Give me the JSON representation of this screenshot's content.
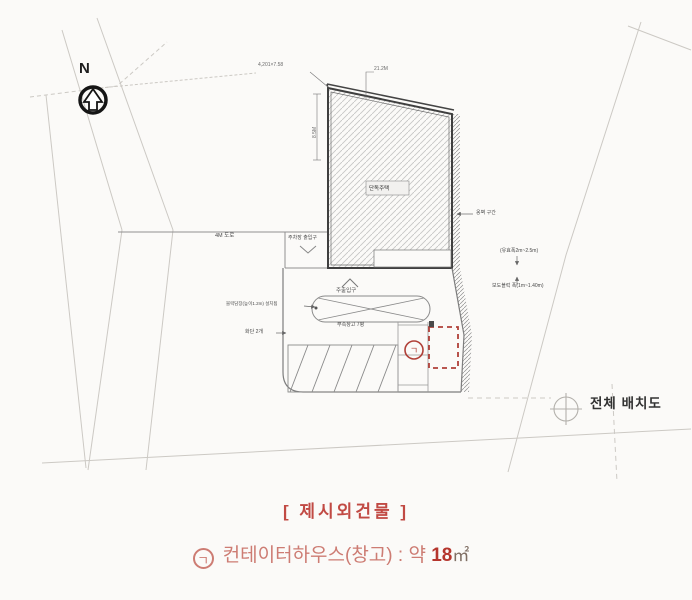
{
  "colors": {
    "red_annotation": "#b04038",
    "caption_heading": "#c14a44",
    "caption_text": "#cd7c73",
    "caption_value": "#b5352d"
  },
  "plan": {
    "north_label": "N",
    "title": "전체 배치도",
    "building": {
      "label": "단독주택"
    },
    "dimensions": {
      "top_left": "4,201×7.58",
      "top_right": "21.2M",
      "left_vertical": "8.5M"
    },
    "labels": {
      "road": "4M 도로",
      "parking_entrance": "주차장 출입구",
      "main_entrance": "주출입구",
      "canopy_note": "부속창고 7평",
      "left_note_1": "블럭담장(높이1.2m) 설치됨",
      "left_note_2": "화단 2개",
      "right_note_1": "옹벽 구간",
      "right_note_2": "(유효폭2m~2.5m)",
      "right_note_3": "보도블럭 폭(1m~1.40m)"
    },
    "marker_char": "ㄱ"
  },
  "caption": {
    "heading": "[ 제시외건물 ]",
    "item": {
      "marker": "ㄱ",
      "text": "컨테이터하우스(창고) : 약",
      "value": "18",
      "unit": "㎡"
    }
  }
}
